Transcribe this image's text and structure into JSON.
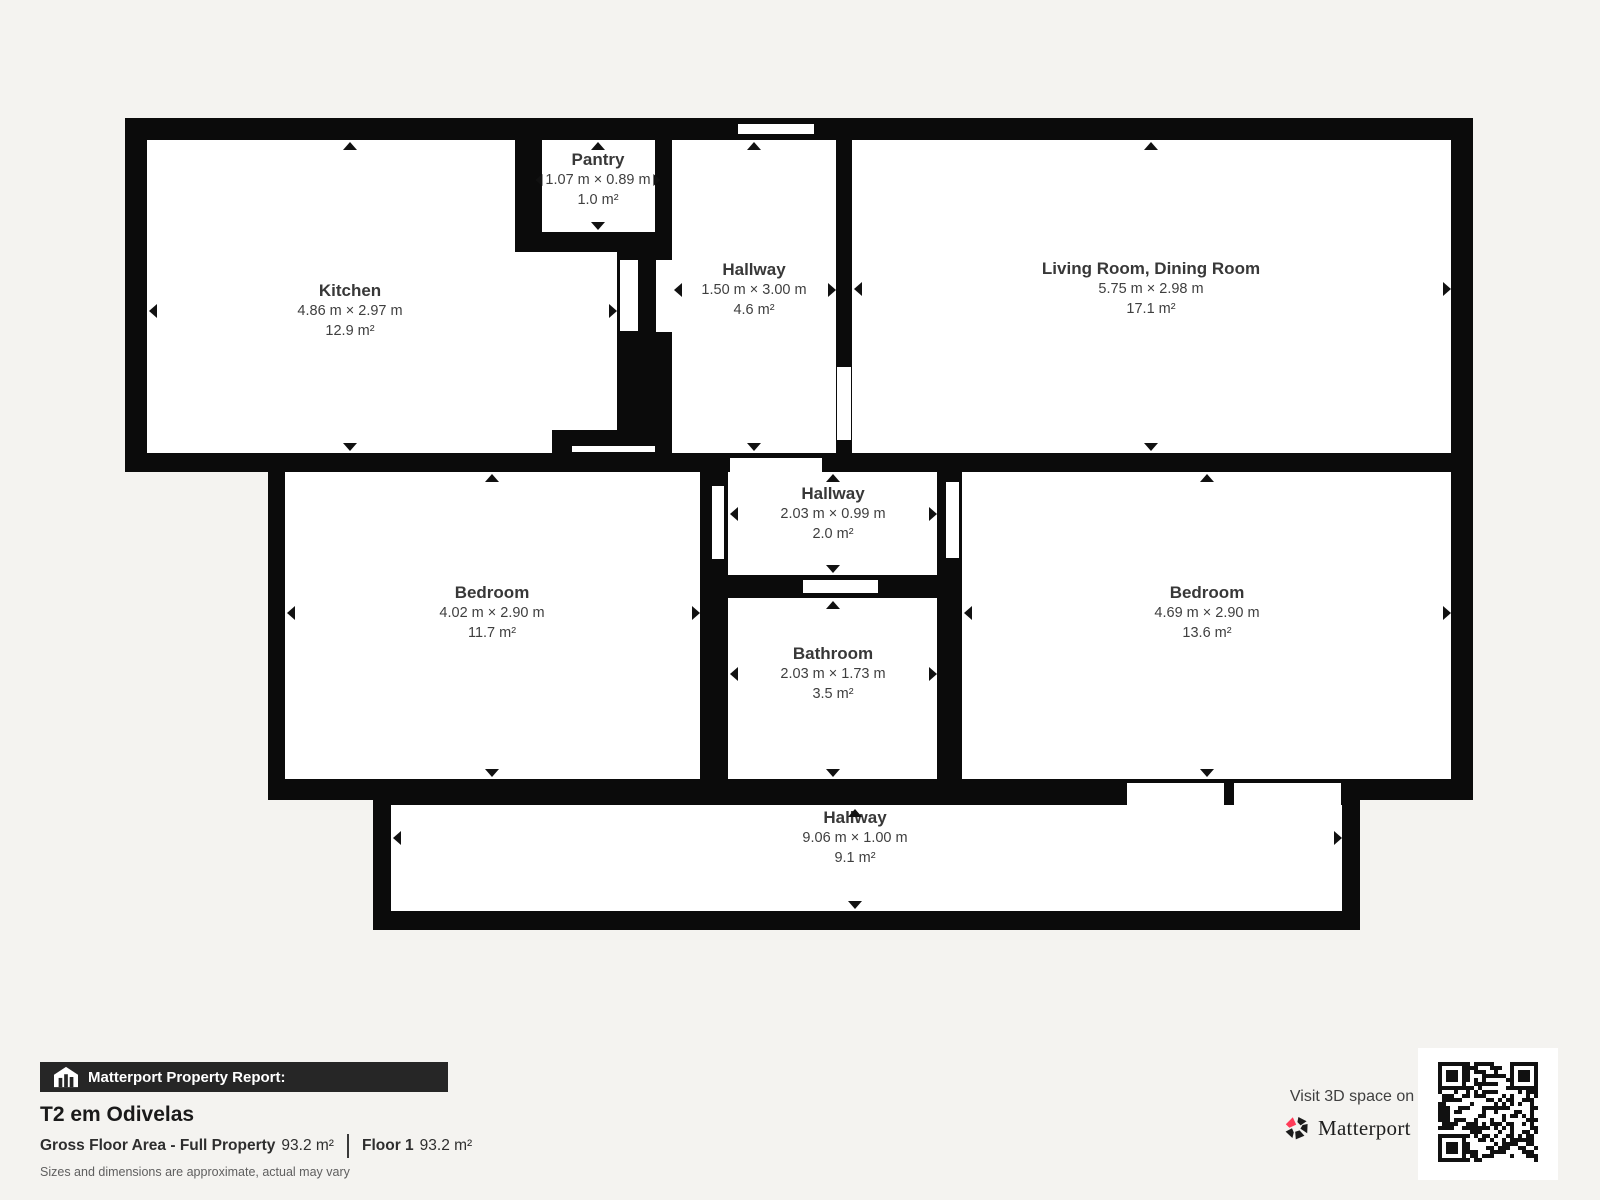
{
  "rooms": [
    {
      "name": "Kitchen",
      "dims": "4.86 m × 2.97 m",
      "area": "12.9 m²"
    },
    {
      "name": "Pantry",
      "dims": "1.07 m × 0.89 m",
      "area": "1.0 m²"
    },
    {
      "name": "Hallway",
      "dims": "1.50 m × 3.00 m",
      "area": "4.6 m²"
    },
    {
      "name": "Living Room, Dining Room",
      "dims": "5.75 m × 2.98 m",
      "area": "17.1 m²"
    },
    {
      "name": "Hallway",
      "dims": "2.03 m × 0.99 m",
      "area": "2.0 m²"
    },
    {
      "name": "Bedroom",
      "dims": "4.02 m × 2.90 m",
      "area": "11.7 m²"
    },
    {
      "name": "Bathroom",
      "dims": "2.03 m × 1.73 m",
      "area": "3.5 m²"
    },
    {
      "name": "Bedroom",
      "dims": "4.69 m × 2.90 m",
      "area": "13.6 m²"
    },
    {
      "name": "Hallway",
      "dims": "9.06 m × 1.00 m",
      "area": "9.1 m²"
    }
  ],
  "report": {
    "bar_label": "Matterport Property Report:",
    "property_title": "T2 em Odivelas",
    "gross_label": "Gross Floor Area - Full Property",
    "gross_value": "93.2 m²",
    "floor_label": "Floor 1",
    "floor_value": "93.2 m²",
    "disclaimer": "Sizes and dimensions are approximate, actual may vary"
  },
  "cta": {
    "visit_label": "Visit 3D space on",
    "brand": "Matterport",
    "brand_mark": "’"
  },
  "colors": {
    "background": "#f4f3f0",
    "wall": "#0b0b0b",
    "room_fill": "#ffffff",
    "room_text": "#3f3f3f",
    "bar_background": "#262626",
    "accent_red": "#ff3b58"
  }
}
